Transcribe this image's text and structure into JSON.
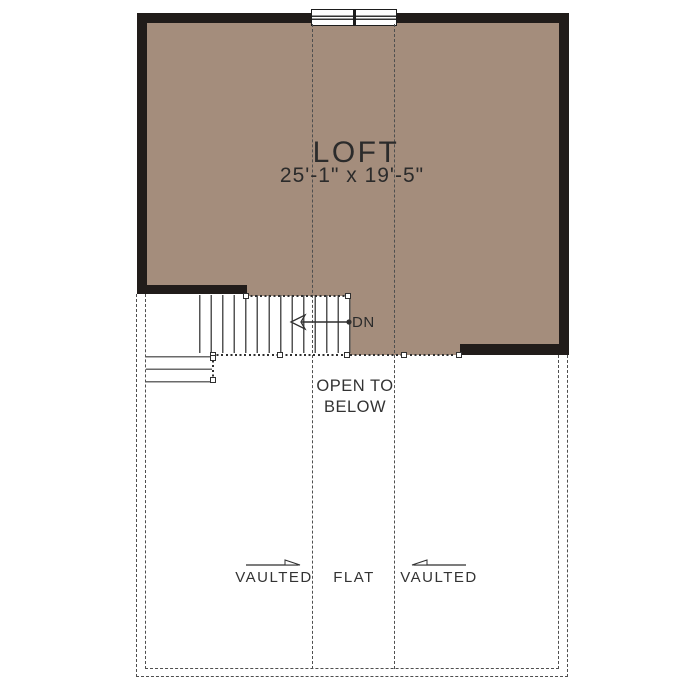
{
  "plan": {
    "room_name": "LOFT",
    "room_dimensions": "25'-1\" x 19'-5\"",
    "stair_label": "DN",
    "open_to_below": {
      "line1": "OPEN TO",
      "line2": "BELOW"
    },
    "ceiling_zones": {
      "left": "VAULTED",
      "middle": "FLAT",
      "right": "VAULTED"
    },
    "icons": {
      "down_arrow": "left-pointing open arrow with start dot (stair down direction)",
      "vault_arrow_left_zone": "right-pointing slope arrow",
      "vault_arrow_right_zone": "left-pointing slope arrow"
    },
    "colors": {
      "floor_fill": "#a48d7c",
      "wall": "#211c1a",
      "stair_line": "#555555",
      "dashed_line": "#4f4f4f",
      "text": "#333333",
      "background": "#ffffff"
    }
  }
}
